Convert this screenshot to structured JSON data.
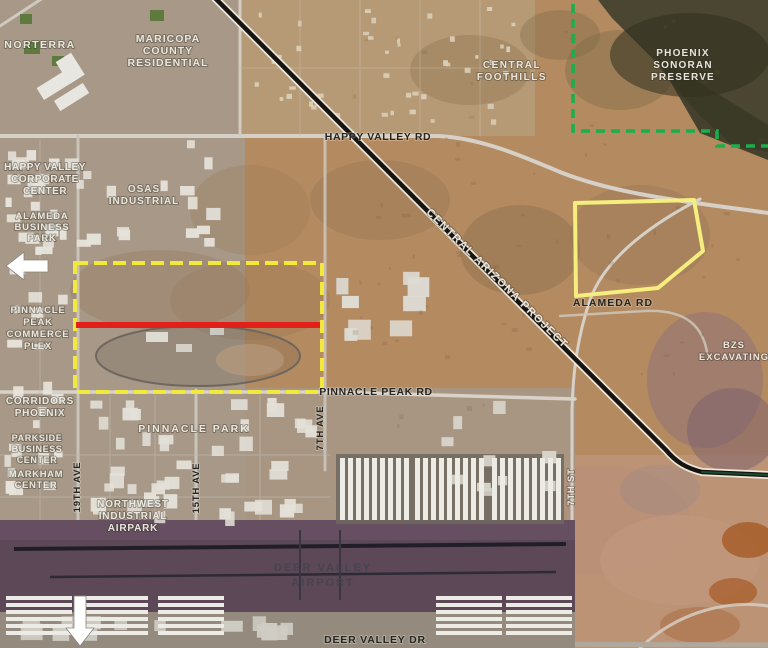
{
  "map": {
    "type": "satellite-aerial-annotated",
    "area": "Deer Valley / North Phoenix, Arizona"
  },
  "colors": {
    "parcel_yellow_dashed": "#f2e93d",
    "parcel_yellow_solid": "#f5ee7e",
    "red_segment": "#e31f1a",
    "preserve_green": "#17b04a",
    "arrow_white": "#ffffff"
  },
  "labels": {
    "norterra": "NORTERRA",
    "maricopa_county_residential": {
      "lines": [
        "MARICOPA",
        "COUNTY",
        "RESIDENTIAL"
      ]
    },
    "central_foothills": {
      "lines": [
        "CENTRAL",
        "FOOTHILLS"
      ]
    },
    "phoenix_sonoran_preserve": {
      "lines": [
        "PHOENIX",
        "SONORAN",
        "PRESERVE"
      ]
    },
    "happy_valley_corporate_center": {
      "lines": [
        "HAPPY VALLEY",
        "CORPORATE",
        "CENTER"
      ]
    },
    "osas_industrial": {
      "lines": [
        "OSAS",
        "INDUSTRIAL"
      ]
    },
    "alameda_business_park": {
      "lines": [
        "ALAMEDA",
        "BUSINESS",
        "PARK"
      ]
    },
    "pinnacle_peak_commerce_plex": {
      "lines": [
        "PINNACLE",
        "PEAK",
        "COMMERCE",
        "PLEX"
      ]
    },
    "corridors_phoenix": {
      "lines": [
        "CORRIDORS",
        "PHOENIX"
      ]
    },
    "parkside_business_center": {
      "lines": [
        "PARKSIDE",
        "BUSINESS",
        "CENTER"
      ]
    },
    "markham_center": {
      "lines": [
        "MARKHAM",
        "CENTER"
      ]
    },
    "pinnacle_park": "PINNACLE PARK",
    "northwest_industrial_airpark": {
      "lines": [
        "NORTHWEST",
        "INDUSTRIAL",
        "AIRPARK"
      ]
    },
    "bzs_excavating": {
      "lines": [
        "BZS",
        "EXCAVATING"
      ]
    },
    "deer_valley_airport": {
      "lines": [
        "DEER VALLEY",
        "AIRPORT"
      ]
    }
  },
  "roads": {
    "happy_valley_rd": "HAPPY VALLEY RD",
    "central_arizona_project": "CENTRAL ARIZONA PROJECT",
    "alameda_rd": "ALAMEDA RD",
    "pinnacle_peak_rd": "PINNACLE PEAK RD",
    "deer_valley_dr": "DEER VALLEY DR",
    "ave_19th": "19TH AVE",
    "ave_15th": "15TH AVE",
    "ave_7th": "7TH AVE",
    "st_7th": "7TH ST"
  }
}
